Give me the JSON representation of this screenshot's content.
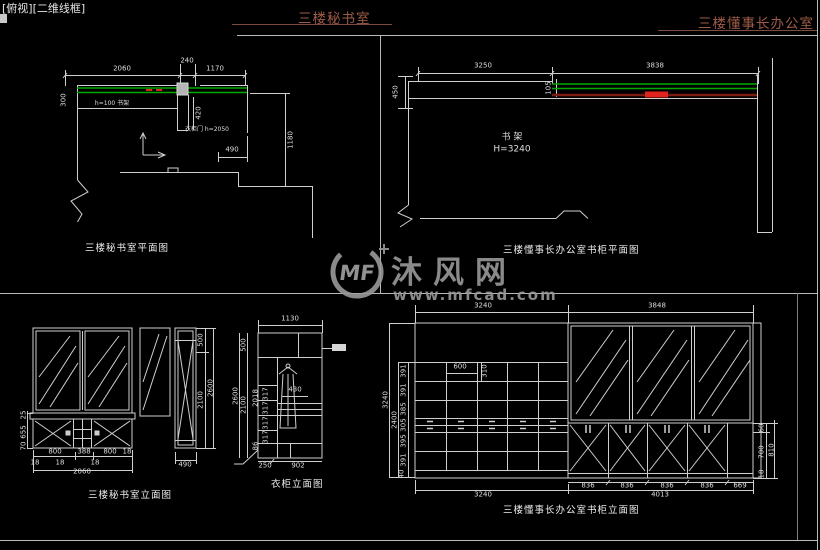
{
  "viewport": {
    "label": "[俯视][二维线框]"
  },
  "titles": {
    "left": "三楼秘书室",
    "right": "三楼懂事长办公室"
  },
  "watermark": {
    "logo": "MF",
    "name": "沐风网",
    "url": "www.mfcad.com"
  },
  "colors": {
    "line": "#cfcfcf",
    "green": "#00a800",
    "red": "#e0231c",
    "maroon": "#7c1a14",
    "title": "#9e5b49",
    "watermark": "#9a9a9a",
    "dim_text": "#dedede"
  },
  "drawings": {
    "secretary_plan": {
      "label": "三楼秘书室平面图",
      "notes": [
        {
          "t": "h=100 书架",
          "x": 112,
          "y": 104,
          "s": 6
        },
        {
          "t": "衣柜门 h=2050",
          "x": 207,
          "y": 130,
          "s": 6
        }
      ],
      "dims": [
        {
          "t": "2060",
          "x": 122,
          "y": 69
        },
        {
          "t": "240",
          "x": 187,
          "y": 61
        },
        {
          "t": "1170",
          "x": 215,
          "y": 69
        },
        {
          "t": "300",
          "x": 64,
          "y": 100,
          "r": 1
        },
        {
          "t": "420",
          "x": 199,
          "y": 113,
          "r": 1
        },
        {
          "t": "1180",
          "x": 291,
          "y": 140,
          "r": 1
        },
        {
          "t": "490",
          "x": 232,
          "y": 150
        }
      ]
    },
    "chairman_plan": {
      "label": "三楼懂事长办公室书柜平面图",
      "notes": [
        {
          "t": "书 架",
          "x": 512,
          "y": 138,
          "s": 9
        },
        {
          "t": "H=3240",
          "x": 512,
          "y": 150,
          "s": 9
        }
      ],
      "dims": [
        {
          "t": "3250",
          "x": 483,
          "y": 66
        },
        {
          "t": "3838",
          "x": 655,
          "y": 66
        },
        {
          "t": "450",
          "x": 396,
          "y": 92,
          "r": 1
        },
        {
          "t": "105",
          "x": 549,
          "y": 88,
          "r": 1
        }
      ]
    },
    "secretary_elevation": {
      "label": "三楼秘书室立面图",
      "notes": [],
      "dims": [
        {
          "t": "500",
          "x": 201,
          "y": 340,
          "r": 1
        },
        {
          "t": "2100",
          "x": 201,
          "y": 400,
          "r": 1
        },
        {
          "t": "2600",
          "x": 211,
          "y": 388,
          "r": 1
        },
        {
          "t": "25",
          "x": 24,
          "y": 415,
          "r": 1
        },
        {
          "t": "655",
          "x": 24,
          "y": 432,
          "r": 1
        },
        {
          "t": "70",
          "x": 24,
          "y": 446,
          "r": 1
        },
        {
          "t": "800",
          "x": 55,
          "y": 452
        },
        {
          "t": "388",
          "x": 84,
          "y": 452
        },
        {
          "t": "800",
          "x": 110,
          "y": 452
        },
        {
          "t": "18",
          "x": 35,
          "y": 463
        },
        {
          "t": "18",
          "x": 60,
          "y": 463
        },
        {
          "t": "18",
          "x": 95,
          "y": 463
        },
        {
          "t": "18",
          "x": 127,
          "y": 452
        },
        {
          "t": "2060",
          "x": 82,
          "y": 472
        },
        {
          "t": "490",
          "x": 185,
          "y": 465
        }
      ]
    },
    "wardrobe_elevation": {
      "label": "衣柜立面图",
      "notes": [],
      "dims": [
        {
          "t": "1130",
          "x": 290,
          "y": 319
        },
        {
          "t": "500",
          "x": 244,
          "y": 345,
          "r": 1
        },
        {
          "t": "2100",
          "x": 244,
          "y": 405,
          "r": 1
        },
        {
          "t": "2600",
          "x": 236,
          "y": 396,
          "r": 1
        },
        {
          "t": "2018",
          "x": 256,
          "y": 398,
          "r": 1
        },
        {
          "t": "317",
          "x": 266,
          "y": 394,
          "r": 1
        },
        {
          "t": "317",
          "x": 266,
          "y": 408,
          "r": 1
        },
        {
          "t": "317",
          "x": 266,
          "y": 423,
          "r": 1
        },
        {
          "t": "317",
          "x": 266,
          "y": 437,
          "r": 1
        },
        {
          "t": "86",
          "x": 256,
          "y": 446,
          "r": 1
        },
        {
          "t": "430",
          "x": 295,
          "y": 390
        },
        {
          "t": "250",
          "x": 265,
          "y": 466
        },
        {
          "t": "902",
          "x": 298,
          "y": 466
        }
      ]
    },
    "bookcase_elevation": {
      "label": "三楼懂事长办公室书柜立面图",
      "notes": [],
      "dims": [
        {
          "t": "3240",
          "x": 483,
          "y": 306
        },
        {
          "t": "3848",
          "x": 657,
          "y": 306
        },
        {
          "t": "600",
          "x": 460,
          "y": 367
        },
        {
          "t": "310",
          "x": 485,
          "y": 371,
          "r": 1
        },
        {
          "t": "391",
          "x": 404,
          "y": 371,
          "r": 1
        },
        {
          "t": "391",
          "x": 404,
          "y": 390,
          "r": 1
        },
        {
          "t": "385",
          "x": 404,
          "y": 409,
          "r": 1
        },
        {
          "t": "305",
          "x": 404,
          "y": 425,
          "r": 1
        },
        {
          "t": "395",
          "x": 404,
          "y": 441,
          "r": 1
        },
        {
          "t": "391",
          "x": 404,
          "y": 460,
          "r": 1
        },
        {
          "t": "40",
          "x": 402,
          "y": 474,
          "r": 1
        },
        {
          "t": "2400",
          "x": 395,
          "y": 420,
          "r": 1
        },
        {
          "t": "3240",
          "x": 386,
          "y": 400,
          "r": 1
        },
        {
          "t": "836",
          "x": 588,
          "y": 486
        },
        {
          "t": "836",
          "x": 627,
          "y": 486
        },
        {
          "t": "836",
          "x": 667,
          "y": 486
        },
        {
          "t": "836",
          "x": 707,
          "y": 486
        },
        {
          "t": "669",
          "x": 740,
          "y": 486
        },
        {
          "t": "3240",
          "x": 483,
          "y": 495
        },
        {
          "t": "4013",
          "x": 660,
          "y": 495
        },
        {
          "t": "60",
          "x": 762,
          "y": 428,
          "r": 1
        },
        {
          "t": "700",
          "x": 762,
          "y": 452,
          "r": 1
        },
        {
          "t": "810",
          "x": 772,
          "y": 450,
          "r": 1
        },
        {
          "t": "18",
          "x": 762,
          "y": 474,
          "r": 1
        }
      ]
    }
  }
}
